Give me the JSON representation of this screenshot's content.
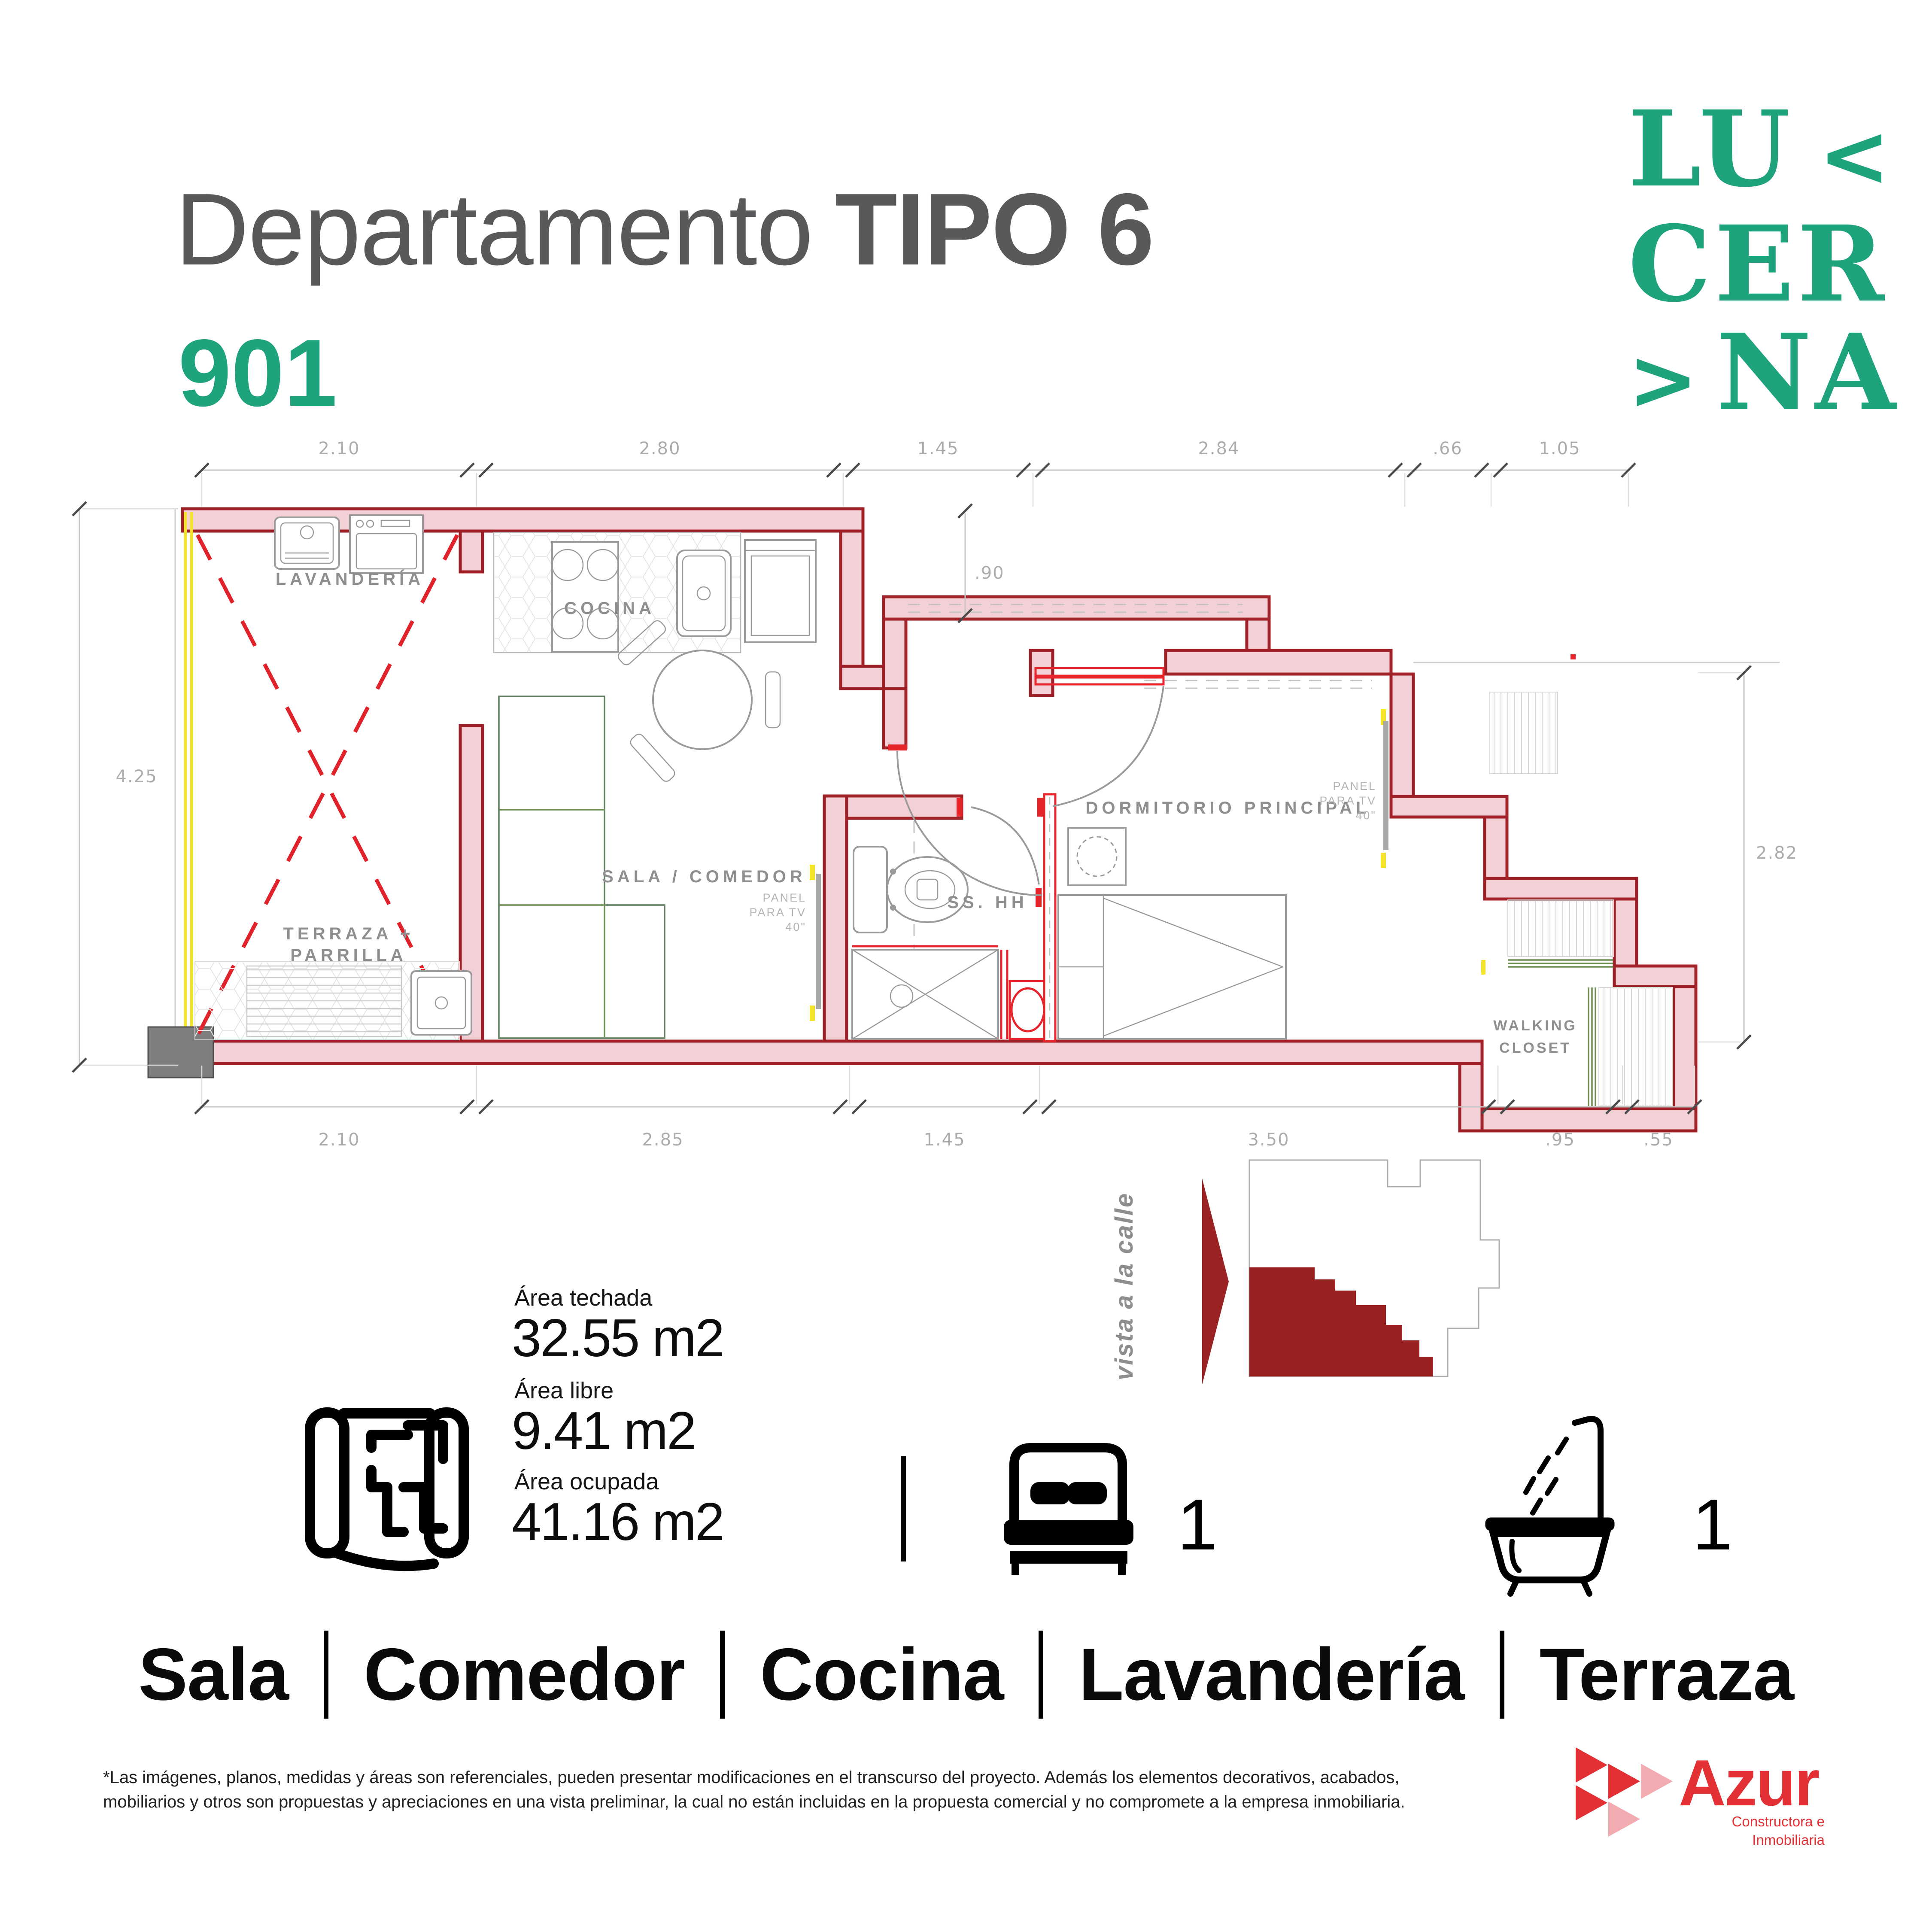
{
  "header": {
    "title_regular": "Departamento",
    "title_bold": "TIPO 6",
    "unit_number": "901"
  },
  "brand": {
    "line1_text": "LU",
    "line1_chevron": "<",
    "line2_text": "CER",
    "line3_chevron": ">",
    "line3_text": "NA"
  },
  "floor_plan": {
    "rooms": {
      "lavanderia": "LAVANDERÍA",
      "cocina": "COCINA",
      "sala_comedor": "SALA  /  COMEDOR",
      "terraza_line1": "TERRAZA  +",
      "terraza_line2": "PARRILLA",
      "bano": "SS.  HH",
      "dormitorio": "DORMITORIO  PRINCIPAL",
      "walking_closet_line1": "WALKING",
      "walking_closet_line2": "CLOSET",
      "tv_panel_line1": "PANEL",
      "tv_panel_line2": "PARA  TV",
      "tv_panel_line3": "40\""
    },
    "dimensions": {
      "top": [
        "2.10",
        "2.80",
        "1.45",
        "2.84",
        ".66",
        "1.05"
      ],
      "bottom": [
        "2.10",
        "2.85",
        "1.45",
        "3.50",
        ".95",
        ".55"
      ],
      "left": "4.25",
      "right": "2.82",
      "kitchen_step": ".90"
    }
  },
  "view_note": {
    "label": "vista a la calle"
  },
  "areas": {
    "techada_label": "Área techada",
    "techada_value": "32.55 m2",
    "libre_label": "Área libre",
    "libre_value": "9.41 m2",
    "ocupada_label": "Área ocupada",
    "ocupada_value": "41.16 m2"
  },
  "features": {
    "bedrooms_count": "1",
    "bathrooms_count": "1"
  },
  "amenities": {
    "items": [
      "Sala",
      "Comedor",
      "Cocina",
      "Lavandería",
      "Terraza"
    ]
  },
  "disclaimer": {
    "line1": "*Las imágenes, planos, medidas y áreas son referenciales, pueden presentar modificaciones en el transcurso del proyecto. Además los elementos decorativos, acabados,",
    "line2": "mobiliarios y otros son propuestas y apreciaciones en una vista preliminar, la cual no están incluidas en la propuesta comercial y no compromete a la empresa inmobiliaria."
  },
  "footer_brand": {
    "name": "Azur",
    "tagline_line1": "Constructora e",
    "tagline_line2": "Inmobiliaria"
  },
  "colors": {
    "brand_green": "#1FA37D",
    "wall_fill": "#F3CFD6",
    "wall_stroke": "#A02028",
    "accent_red": "#E5242C",
    "unit_red": "#9A2121",
    "highlight_yellow": "#F5E32A",
    "azur_red": "#E23034"
  }
}
